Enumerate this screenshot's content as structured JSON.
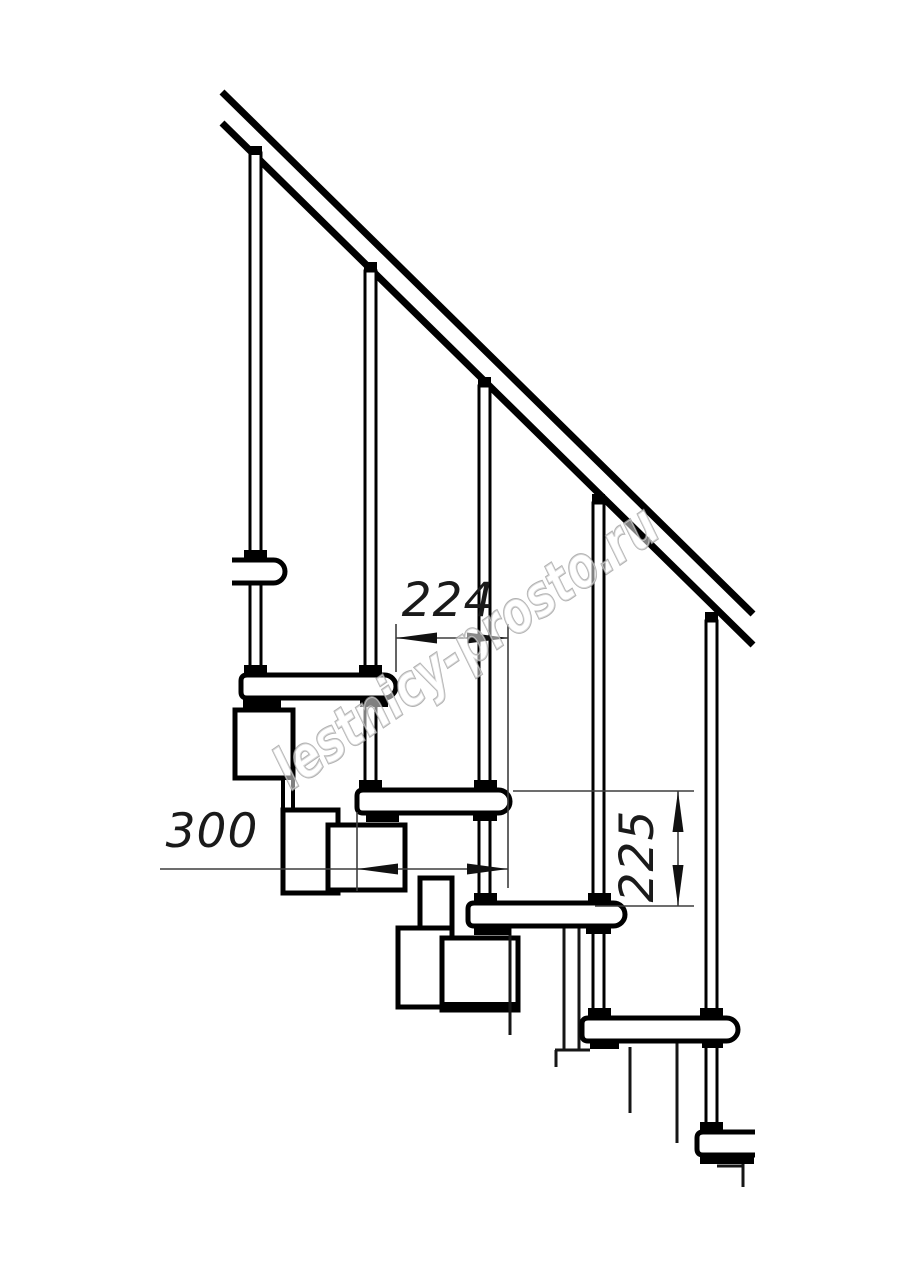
{
  "drawing": {
    "watermark": {
      "text": "lestnicy-prosto.ru",
      "color": "#9e9e9e"
    },
    "dimensions": [
      {
        "id": "step-run",
        "value": "224",
        "orientation": "horizontal"
      },
      {
        "id": "tread-depth",
        "value": "300",
        "orientation": "horizontal"
      },
      {
        "id": "step-rise",
        "value": "225",
        "orientation": "vertical"
      }
    ],
    "colors": {
      "outline": "#000000",
      "dimension_line": "#3d3d3d",
      "text": "#1a1a1a",
      "background": "#ffffff"
    }
  }
}
